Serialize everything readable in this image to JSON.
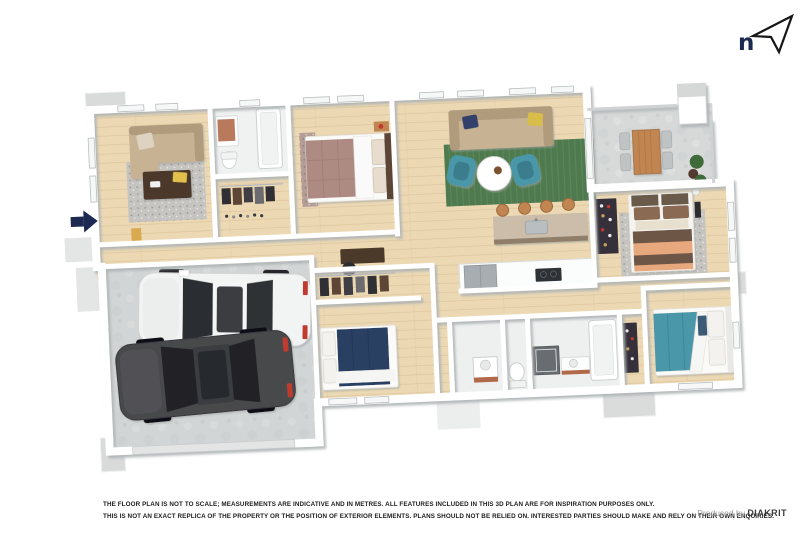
{
  "compass": {
    "letter": "n"
  },
  "footer": {
    "line1": "THE FLOOR PLAN IS NOT TO SCALE; MEASUREMENTS ARE INDICATIVE AND IN METRES. ALL FEATURES INCLUDED IN THIS 3D PLAN ARE FOR INSPIRATION PURPOSES ONLY.",
    "line2": "THIS IS NOT AN EXACT REPLICA OF THE PROPERTY OR THE POSITION OF EXTERIOR ELEMENTS. PLANS SHOULD NOT BE RELIED ON. INTERESTED PARTIES SHOULD MAKE AND RELY ON THEIR OWN ENQUIRIES.",
    "credit_prefix": "Produced by",
    "credit_brand": "DIAKRIT"
  },
  "floorplan": {
    "colors": {
      "wall": "#ffffff",
      "wall_shadow": "#aeb2b3",
      "wood": "#ecd9b4",
      "wood_line": "#ddc69e",
      "concrete": "#d7d9d9",
      "rug_gray": "#c6c4c0",
      "rug_green": "#4f7a4f",
      "sofa_tan": "#c8b294",
      "sofa_dark": "#b19b7d",
      "teal": "#4897a8",
      "navy": "#2c4164",
      "mauve": "#ad8b82",
      "wood_dark": "#4b3929",
      "wood_mid": "#c08551",
      "peach": "#e8a87d",
      "brown": "#6e5747",
      "yellow": "#e3c04b",
      "copper": "#b06a4a",
      "gray_item": "#a7adb0",
      "dark_item": "#35303a",
      "car_white": "#f2f3f3",
      "car_dark": "#47484b",
      "glass_dark": "#2b2d31",
      "red": "#c03a2e",
      "plant_green": "#3f6b3b",
      "arrow_navy": "#1c2950",
      "text_dark": "#1c1c1c",
      "credit_gray": "#9b9b9b",
      "credit_dark": "#3d3d3d"
    }
  }
}
